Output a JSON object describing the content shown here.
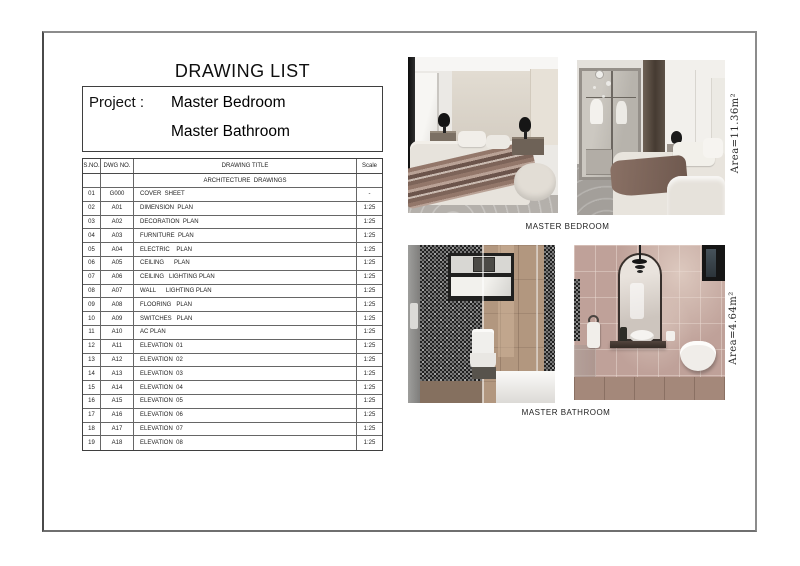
{
  "page": {
    "title": "DRAWING LIST",
    "project_label": "Project :",
    "project_lines": [
      "Master Bedroom",
      "Master Bathroom"
    ]
  },
  "table": {
    "headers": {
      "sno": "S.NO.",
      "dwg": "DWG NO.",
      "title": "DRAWING TITLE",
      "scale": "Scale"
    },
    "section": "ARCHITECTURE  DRAWINGS",
    "rows": [
      {
        "sno": "01",
        "dwg": "G000",
        "title": "COVER  SHEET",
        "scale": "-"
      },
      {
        "sno": "02",
        "dwg": "A01",
        "title": "DIMENSION  PLAN",
        "scale": "1:25"
      },
      {
        "sno": "03",
        "dwg": "A02",
        "title": "DECORATION  PLAN",
        "scale": "1:25"
      },
      {
        "sno": "04",
        "dwg": "A03",
        "title": "FURNITURE  PLAN",
        "scale": "1:25"
      },
      {
        "sno": "05",
        "dwg": "A04",
        "title": "ELECTRIC    PLAN",
        "scale": "1:25"
      },
      {
        "sno": "06",
        "dwg": "A05",
        "title": "CEILING      PLAN",
        "scale": "1:25"
      },
      {
        "sno": "07",
        "dwg": "A06",
        "title": "CEILING   LIGHTING PLAN",
        "scale": "1:25"
      },
      {
        "sno": "08",
        "dwg": "A07",
        "title": "WALL      LIGHTING PLAN",
        "scale": "1:25"
      },
      {
        "sno": "09",
        "dwg": "A08",
        "title": "FLOORING   PLAN",
        "scale": "1:25"
      },
      {
        "sno": "10",
        "dwg": "A09",
        "title": "SWITCHES   PLAN",
        "scale": "1:25"
      },
      {
        "sno": "11",
        "dwg": "A10",
        "title": "AC PLAN",
        "scale": "1:25"
      },
      {
        "sno": "12",
        "dwg": "A11",
        "title": "ELEVATION  01",
        "scale": "1:25"
      },
      {
        "sno": "13",
        "dwg": "A12",
        "title": "ELEVATION  02",
        "scale": "1:25"
      },
      {
        "sno": "14",
        "dwg": "A13",
        "title": "ELEVATION  03",
        "scale": "1:25"
      },
      {
        "sno": "15",
        "dwg": "A14",
        "title": "ELEVATION  04",
        "scale": "1:25"
      },
      {
        "sno": "16",
        "dwg": "A15",
        "title": "ELEVATION  05",
        "scale": "1:25"
      },
      {
        "sno": "17",
        "dwg": "A16",
        "title": "ELEVATION  06",
        "scale": "1:25"
      },
      {
        "sno": "18",
        "dwg": "A17",
        "title": "ELEVATION  07",
        "scale": "1:25"
      },
      {
        "sno": "19",
        "dwg": "A18",
        "title": "ELEVATION  08",
        "scale": "1:25"
      }
    ]
  },
  "photos": {
    "bedroom_caption": "MASTER BEDROOM",
    "bathroom_caption": "MASTER BATHROOM",
    "bedroom_area": "Area=11.36m²",
    "bathroom_area": "Area=4.64m²"
  },
  "colors": {
    "frame_border": "#8c8c8c",
    "table_border": "#3f3f3f",
    "text": "#1a1a1a"
  }
}
